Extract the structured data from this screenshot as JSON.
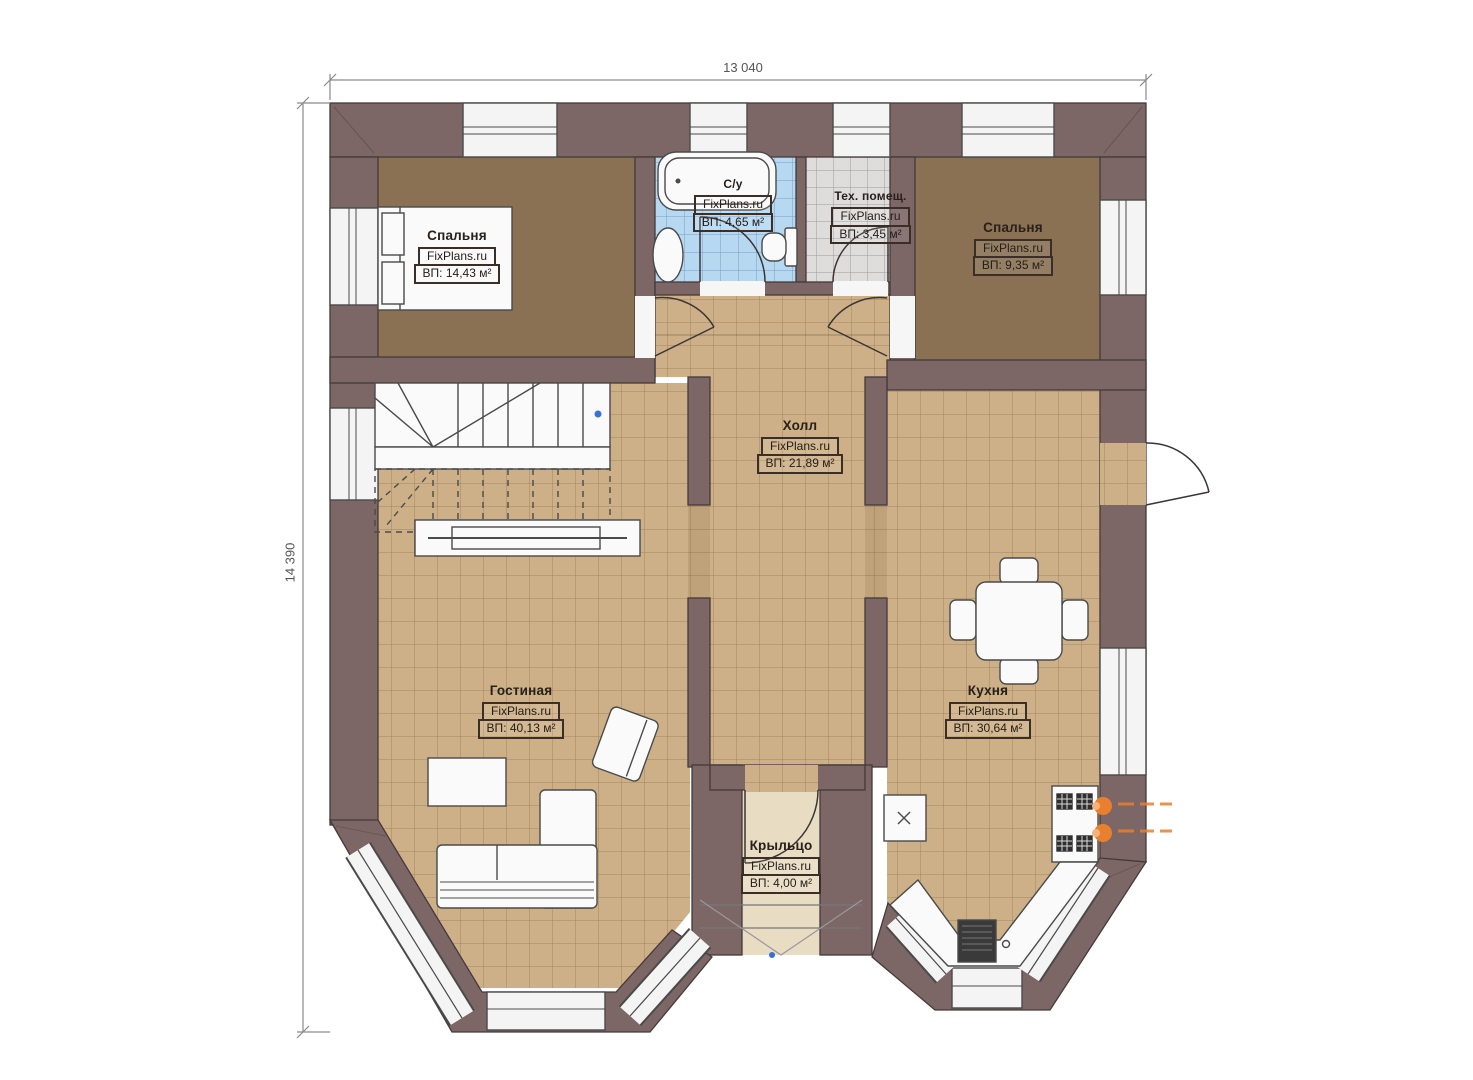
{
  "meta": {
    "plan_type": "floor-plan",
    "watermark": "FixPlans.ru"
  },
  "dimensions": {
    "width_label": "13 040",
    "height_label": "14 390"
  },
  "rooms": [
    {
      "id": "bedroom-1",
      "name": "Спальня",
      "watermark": "FixPlans.ru",
      "area": "ВП: 14,43 м²"
    },
    {
      "id": "bathroom",
      "name": "С/у",
      "watermark": "FixPlans.ru",
      "area": "ВП: 4,65 м²"
    },
    {
      "id": "tech-room",
      "name": "Тех. помещ.",
      "watermark": "FixPlans.ru",
      "area": "ВП: 3,45 м²"
    },
    {
      "id": "bedroom-2",
      "name": "Спальня",
      "watermark": "FixPlans.ru",
      "area": "ВП: 9,35 м²"
    },
    {
      "id": "hall",
      "name": "Холл",
      "watermark": "FixPlans.ru",
      "area": "ВП: 21,89 м²"
    },
    {
      "id": "living-room",
      "name": "Гостиная",
      "watermark": "FixPlans.ru",
      "area": "ВП: 40,13 м²"
    },
    {
      "id": "kitchen",
      "name": "Кухня",
      "watermark": "FixPlans.ru",
      "area": "ВП: 30,64 м²"
    },
    {
      "id": "porch",
      "name": "Крыльцо",
      "watermark": "FixPlans.ru",
      "area": "ВП: 4,00 м²"
    }
  ],
  "colors": {
    "wall": "#7c6666",
    "floor_tile": "#cdb087",
    "carpet": "#8a7153",
    "bath_tile": "#b7d8f1",
    "tech_tile": "#dedddb",
    "porch_floor": "#e8dcc3",
    "accent_orange": "#e8802e"
  }
}
